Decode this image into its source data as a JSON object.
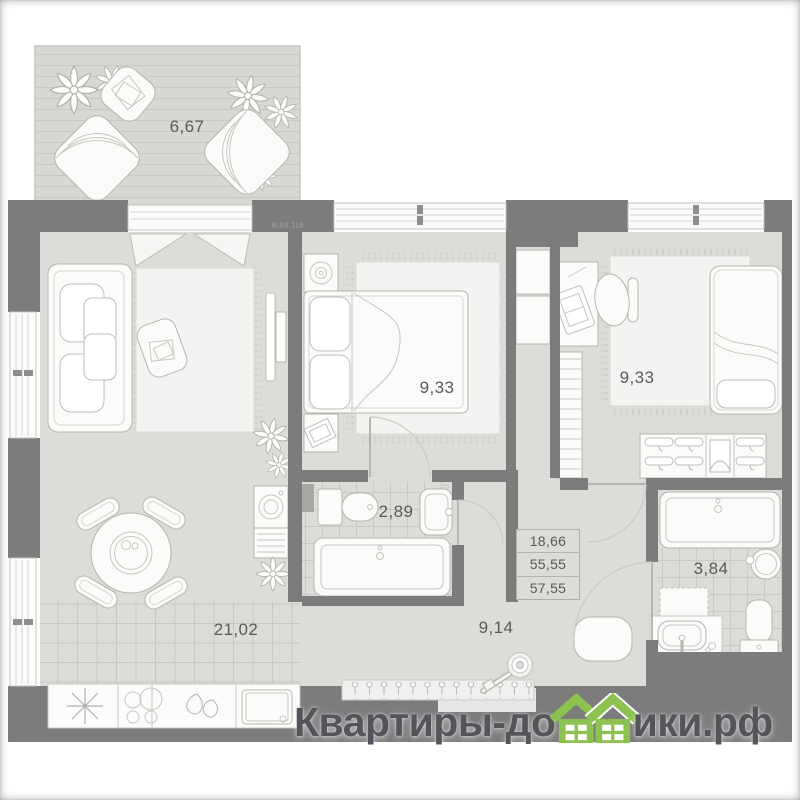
{
  "unit_code": "В.03.116",
  "areas": {
    "terrace": "6,67",
    "kitchen_living": "21,02",
    "bedroom1": "9,33",
    "bedroom2": "9,33",
    "bathroom_small": "2,89",
    "bathroom_large": "3,84",
    "hallway": "9,14"
  },
  "summary_box": {
    "rows": [
      "18,66",
      "55,55",
      "57,55"
    ]
  },
  "watermark": {
    "prefix": "Квартиры-до",
    "suffix": "ики.рф",
    "full_text": "Квартиры-домики.рф"
  },
  "colors": {
    "wall": "#7c7c7c",
    "floor": "#dcdcd9",
    "accent_green": "#8dc251",
    "label_text": "#5b5b5b",
    "watermark_text": "#54555a"
  }
}
